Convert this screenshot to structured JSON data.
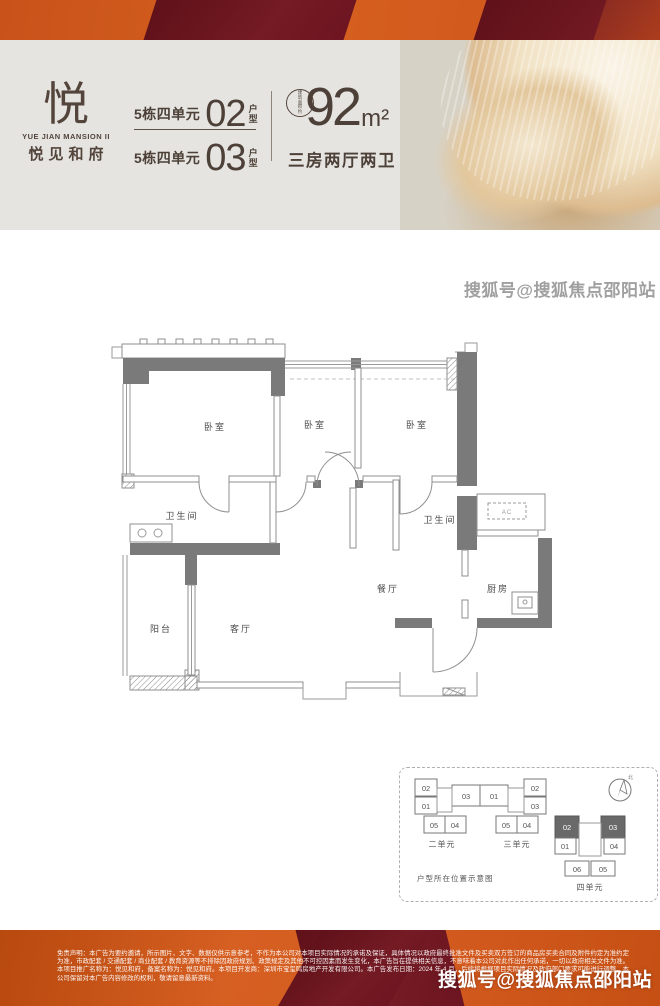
{
  "header": {
    "logo_glyph": "悦",
    "logo_en": "YUE JIAN MANSION II",
    "logo_cn": "悦见和府",
    "unit_rows": [
      {
        "building": "5栋四单元",
        "number": "02",
        "suffix": "户型"
      },
      {
        "building": "5栋四单元",
        "number": "03",
        "suffix": "户型"
      }
    ],
    "area_label": "建筑面积约",
    "area_number": "92",
    "area_unit": "m²",
    "spec": "三房两厅两卫"
  },
  "floorplan": {
    "bedroom": "卧室",
    "bathroom": "卫生间",
    "dining": "餐厅",
    "kitchen": "厨房",
    "living": "客厅",
    "balcony": "阳台",
    "ac": "AC"
  },
  "location": {
    "caption": "户型所在位置示意图",
    "north": "北",
    "unit2": {
      "label": "二单元",
      "cells": [
        "02",
        "01",
        "03",
        "05",
        "04"
      ]
    },
    "unit3": {
      "label": "三单元",
      "cells": [
        "01",
        "02",
        "03",
        "05",
        "04"
      ]
    },
    "unit4": {
      "label": "四单元",
      "cells": [
        "02",
        "03",
        "01",
        "04",
        "06",
        "05"
      ]
    }
  },
  "footer": {
    "disclaimer": "免责声明：本广告为要约邀请，所示图片、文字、数据仅供示意参考，不作为本公司对本项目实际情况的承诺及保证，具体情况以政府最终批准文件及买卖双方签订的商品房买卖合同及附件约定为准约定为准，市政配套 / 交通配套 / 商业配套 / 教育资源等不排除因政府规划、政策规定及其他不可控因素而发生变化，本广告旨在提供相关信息，不意味着本公司对此作出任何承诺，一切以政府相关文件为准。本项目推广名称为：悦见和府，备案名称为：悦见和府。本项目开发商：深圳市宝玺鸣房地产开发有限公司。本广告发布日期：2024 年 4 月，后续将根据项目实际情况及政府部门要求可能进行调整，本公司保留对本广告内容修改的权利，敬请留意最新资料。",
    "watermark": "搜狐号@搜狐焦点邵阳站"
  },
  "watermark_mid": "搜狐号@搜狐焦点邵阳站",
  "colors": {
    "orange": "#d2591d",
    "maroon": "#6c1420",
    "header_beige": "#e5e4e0",
    "flower_bg": "#d7d2c6",
    "text_brown": "#4c4038",
    "wall_gray": "#7a7a7a",
    "highlight_cell": "#696969"
  }
}
